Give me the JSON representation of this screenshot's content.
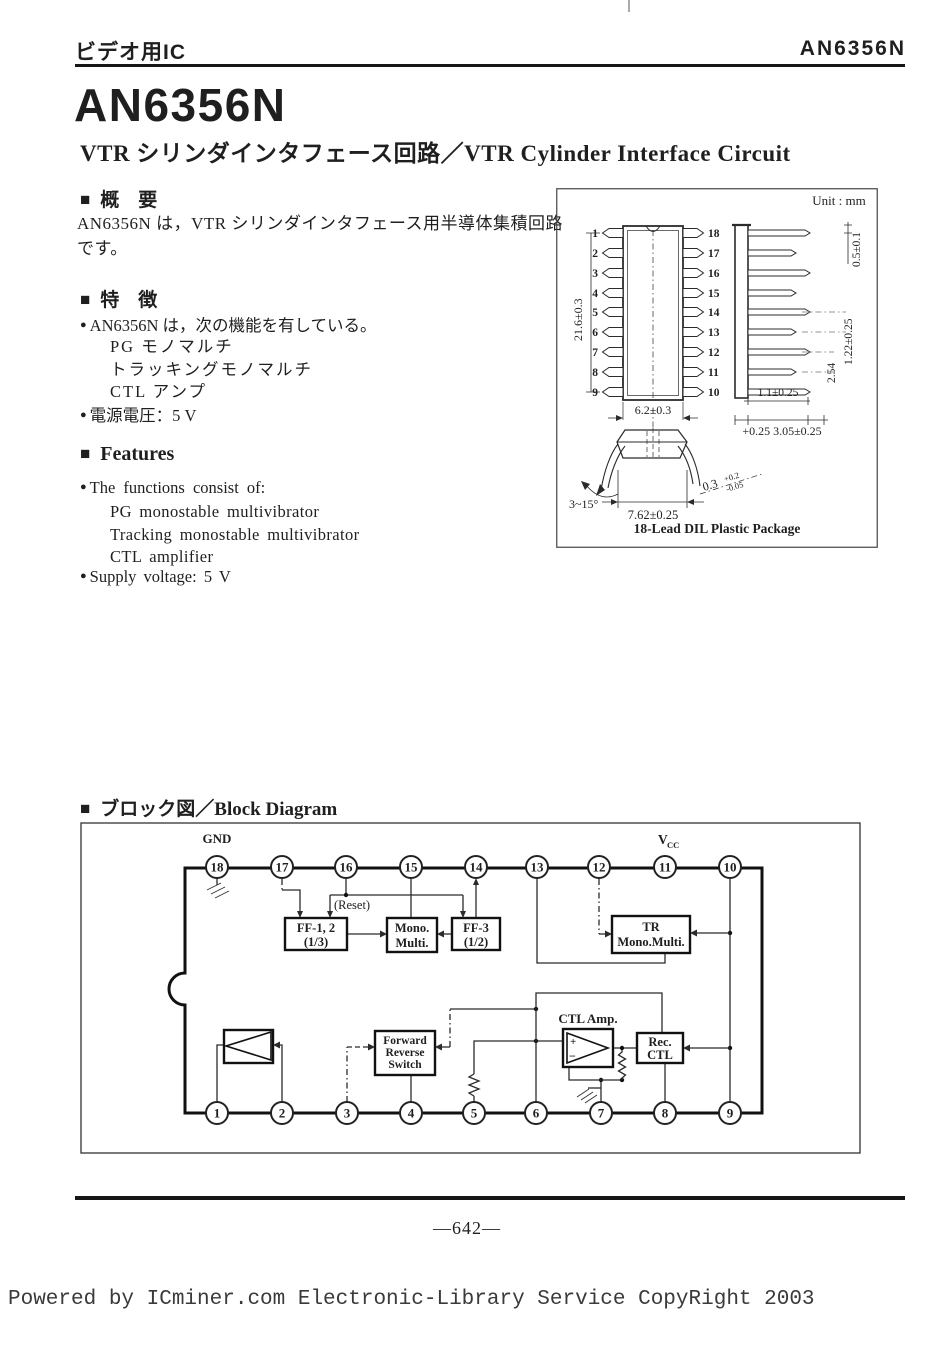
{
  "page": {
    "header_left": "ビデオ用IC",
    "header_right": "AN6356N",
    "title": "AN6356N",
    "subtitle": "VTR シリンダインタフェース回路／VTR Cylinder Interface Circuit",
    "page_number": "—642—",
    "footer": "Powered by ICminer.com Electronic-Library Service CopyRight 2003",
    "square_marker": "■",
    "bullet": "●"
  },
  "overview": {
    "title": "概　要",
    "body": "AN6356N は，VTR シリンダインタフェース用半導体集積回路です。"
  },
  "features_jp": {
    "title": "特　徴",
    "item1": "AN6356N は，次の機能を有している。",
    "sub_items": [
      "PG モノマルチ",
      "トラッキングモノマルチ",
      "CTL アンプ"
    ],
    "item2": "電源電圧：5 V"
  },
  "features_en": {
    "title": "Features",
    "item1": "The functions consist of:",
    "sub_items": [
      "PG monostable multivibrator",
      "Tracking monostable multivibrator",
      "CTL amplifier"
    ],
    "item2": "Supply voltage: 5 V"
  },
  "package": {
    "unit": "Unit : mm",
    "caption": "18-Lead DIL Plastic Package",
    "pins_left": [
      "1",
      "2",
      "3",
      "4",
      "5",
      "6",
      "7",
      "8",
      "9"
    ],
    "pins_right": [
      "18",
      "17",
      "16",
      "15",
      "14",
      "13",
      "12",
      "11",
      "10"
    ],
    "dims": {
      "body_length": "21.6±0.3",
      "body_width": "6.2±0.3",
      "lead_tip": "0.5±0.1",
      "lead_pitch": "1.22±0.25",
      "row_pitch": "2.54",
      "lead_width": "1.1±0.25",
      "seating": "+0.25 3.05±0.25",
      "lead_angle": "3~15°",
      "row_spacing": "7.62±0.25",
      "lead_thickness": "0.3",
      "thickness_tol_plus": "+0.2",
      "thickness_tol_minus": "-0.05"
    }
  },
  "block": {
    "title": "ブロック図／Block Diagram",
    "gnd": "GND",
    "vcc_v": "V",
    "vcc_sub": "CC",
    "reset": "(Reset)",
    "pins_top": [
      "18",
      "17",
      "16",
      "15",
      "14",
      "13",
      "12",
      "11",
      "10"
    ],
    "pins_bottom": [
      "1",
      "2",
      "3",
      "4",
      "5",
      "6",
      "7",
      "8",
      "9"
    ],
    "ff12_line1": "FF-1, 2",
    "ff12_line2": "(1/3)",
    "mono_line1": "Mono.",
    "mono_line2": "Multi.",
    "ff3_line1": "FF-3",
    "ff3_line2": "(1/2)",
    "tr_line1": "TR",
    "tr_line2": "Mono.Multi.",
    "frs_line1": "Forward",
    "frs_line2": "Reverse",
    "frs_line3": "Switch",
    "ctl_label": "CTL Amp.",
    "rec_line1": "Rec.",
    "rec_line2": "CTL",
    "plus": "+",
    "minus": "−"
  }
}
